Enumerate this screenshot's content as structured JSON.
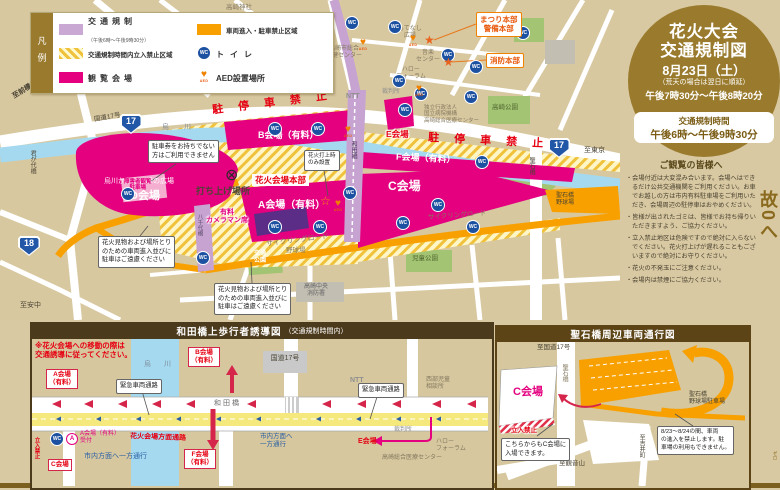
{
  "legend": {
    "title": "凡例",
    "col1": [
      {
        "label": "交通規制",
        "sub": "（午後6時～午後9時30分）"
      },
      {
        "label": "交通規制時間内立入禁止区域",
        "sub": ""
      },
      {
        "label": "観覧会場",
        "sub": ""
      }
    ],
    "col2": [
      {
        "label": "車両進入・駐車禁止区域"
      },
      {
        "label": "トイレ"
      },
      {
        "label": "AED設置場所"
      }
    ]
  },
  "circle": {
    "title1": "花火大会",
    "title2": "交通規制図",
    "date": "8月23日（土）",
    "rain": "（荒天の場合は翌日に順延）",
    "time": "午後7時30分～午後8時20分",
    "reg_label": "交通規制時間",
    "reg_time": "午後6時～午後9時30分"
  },
  "notices": {
    "title": "ご観覧の皆様へ",
    "items": [
      "・会場付近は大変混み合います。会場へはできるだけ公共交通機関をご利用ください。お車でお越しの方は市内有料駐車場をご利用いただき、会場周辺の駐停車はおやめください。",
      "・皆様が出されたゴミは、皆様でお持ち帰りいただきますよう、ご協力ください。",
      "・立入禁止地区は危険ですので絶対に入らないでください。花火打上げが遅れることもございますので絶対にお守りください。",
      "・花火の不発玉にご注意ください。",
      "・会場内は禁煙にご協力ください。"
    ]
  },
  "slogan": {
    "text": "ゆずり合う　その優しさが　事故0へ",
    "ruby": "ゼロ"
  },
  "icons": {
    "wc": "WC",
    "aed": "AED",
    "heart": "♥",
    "star": "★",
    "star_o": "☆",
    "launch": "⊗",
    "r17": "17",
    "r18": "18",
    "circle_a": "A"
  },
  "map": {
    "to_maebashi": "至前橋",
    "takasaki_jinja": "高崎神社",
    "chuo_elem": "中央小",
    "kimigayo_bridge": "君が代橋",
    "route17": "国道17号",
    "karasu_river": "烏　川",
    "no_parking": "駐 停 車 禁 止",
    "b_venue": "B会場（有料）",
    "d_venue": "D会場",
    "d_park": "烏川かわなか緑の広場",
    "disabled_parking": "障害者観覧\n駐車場",
    "launch_site": "打ち上げ場所",
    "hq": "花火会場本部",
    "a_venue": "A会場（有料）",
    "cameraman": "有料\nカメラマン席",
    "e_venue": "E会場",
    "f_venue": "F会場（有料）",
    "c_venue": "C会場",
    "cycling_road": "サイクリングロード",
    "to_tokyo": "至東京",
    "hijiri_bridge": "聖石橋",
    "hijiri_ballpark": "聖石橋\n野球場",
    "takasaki_park": "高崎公園",
    "kotsu_park": "交通\n公園",
    "ballfield": "野球場",
    "jido_park": "児童公園",
    "fire_station": "高崎中央\n消防署",
    "ntt": "NTT",
    "motenashi": "もてなし\n広場",
    "ongaku": "音楽\nセンター",
    "hoken": "高崎市総合\n保健センター",
    "hello_forum": "ハロー\nフォーラム",
    "court": "裁判所",
    "hospital": "独立行政法人\n国立病院機構\n高崎総合医療センター",
    "matsuri_hq": "まつり本部\n警備本部",
    "fire_hq": "消防本部",
    "to_annaka": "至安中",
    "yachiyo_bridge": "八千代橋",
    "wada_bridge": "和田橋",
    "co_parking": "駐車券をお持ちでない\n方はご利用できません",
    "co_no_entry": "花火見物および場所とり\nのための車両進入並びに\n駐車はご遠慮ください",
    "co_launch_only": "花火打上時\nのみ設置"
  },
  "wada": {
    "title": "和田橋上歩行者誘導図",
    "title_sub": "（交通規制時間内）",
    "note": "※花火会場への移動の際は\n交通誘導に従ってください。",
    "river": "烏　川",
    "bridge": "和田橋",
    "venue_a": "A会場\n（有料）",
    "venue_b": "B会場\n（有料）",
    "venue_f": "F会場\n（有料）",
    "venue_c": "C会場",
    "venue_e": "E会場",
    "reception": "A会場（有料）\n受付",
    "emergency_route": "緊急車両通路",
    "corridor": "花火会場方面通路",
    "oneway": "市内方面へ一方通行",
    "oneway2": "市内方面へ\n一方通行",
    "route17_box": "国道17号",
    "ntt": "NTT",
    "child_office": "西部児童\n相談所",
    "court": "裁判所",
    "hello_forum": "ハロー\nフォーラム",
    "medical_center": "高崎総合医療センター",
    "keep_out": "立入禁止"
  },
  "hijiri": {
    "title": "聖石橋周辺車両通行図",
    "to_route17": "至国道17号",
    "bridge": "聖石橋",
    "venue_c": "C会場",
    "keep_out": "立入禁止",
    "co_entry": "こちらからもC会場に\n入場できます。",
    "ballpark": "聖石橋\n野球場駐車場",
    "co_closed": "8/23～8/24の間、車両\nの進入を禁止します。駐\n車場の利用もできません。",
    "to_yoshii": "至吉井町",
    "to_kannon": "至観音山"
  }
}
